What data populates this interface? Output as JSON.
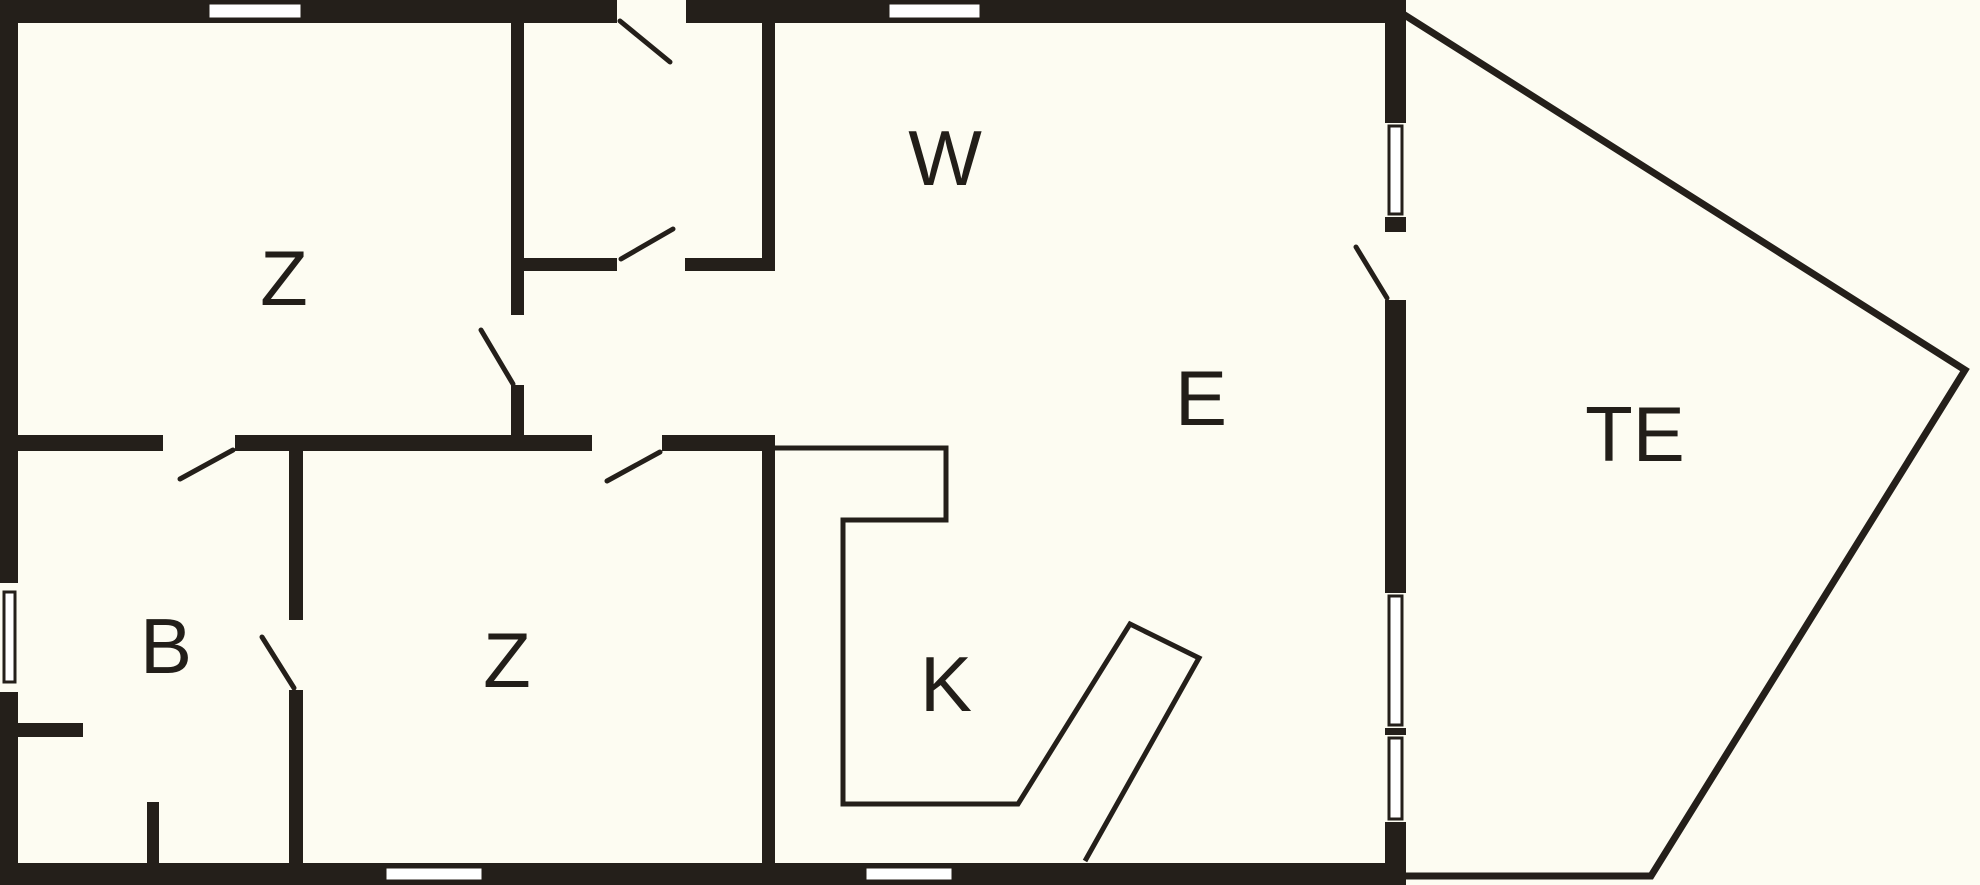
{
  "meta": {
    "title": "floor-plan",
    "canvas": {
      "w": 1980,
      "h": 885
    }
  },
  "colors": {
    "background": "#fdfcf2",
    "wall": "#241f1a",
    "line": "#241f1a",
    "window_fill": "#ffffff",
    "label": "#221e19"
  },
  "plan": {
    "font_size": 78,
    "stroke_widths": {
      "window": 3,
      "swing": 5,
      "counter": 5,
      "terrace": 7
    },
    "labels": [
      {
        "id": "room-label-z-top",
        "text": "Z",
        "x": 284,
        "y": 278
      },
      {
        "id": "room-label-w",
        "text": "W",
        "x": 945,
        "y": 158
      },
      {
        "id": "room-label-e",
        "text": "E",
        "x": 1201,
        "y": 398
      },
      {
        "id": "room-label-te",
        "text": "TE",
        "x": 1635,
        "y": 434
      },
      {
        "id": "room-label-b",
        "text": "B",
        "x": 166,
        "y": 646
      },
      {
        "id": "room-label-z-bottom",
        "text": "Z",
        "x": 507,
        "y": 660
      },
      {
        "id": "room-label-k",
        "text": "K",
        "x": 946,
        "y": 684
      }
    ],
    "walls": [
      {
        "id": "wall-top",
        "x": 0,
        "y": 0,
        "w": 1405,
        "h": 23
      },
      {
        "id": "wall-left",
        "x": 0,
        "y": 0,
        "w": 18,
        "h": 885
      },
      {
        "id": "wall-bottom",
        "x": 0,
        "y": 863,
        "w": 1405,
        "h": 22
      },
      {
        "id": "wall-right",
        "x": 1385,
        "y": 0,
        "w": 21,
        "h": 885
      },
      {
        "id": "wall-z1-east",
        "x": 511,
        "y": 23,
        "w": 13,
        "h": 412
      },
      {
        "id": "wall-hall-south",
        "x": 523,
        "y": 258,
        "w": 252,
        "h": 13
      },
      {
        "id": "wall-hall-east",
        "x": 762,
        "y": 23,
        "w": 13,
        "h": 248
      },
      {
        "id": "wall-mid-divider",
        "x": 18,
        "y": 435,
        "w": 757,
        "h": 16
      },
      {
        "id": "wall-b-east",
        "x": 289,
        "y": 451,
        "w": 14,
        "h": 412
      },
      {
        "id": "wall-k-west",
        "x": 762,
        "y": 435,
        "w": 13,
        "h": 428
      },
      {
        "id": "wall-b-stub-h",
        "x": 18,
        "y": 723,
        "w": 65,
        "h": 14
      },
      {
        "id": "wall-b-stub-v",
        "x": 147,
        "y": 802,
        "w": 12,
        "h": 61
      }
    ],
    "openings": [
      {
        "id": "opening-entry-door",
        "x": 617,
        "y": 0,
        "w": 69,
        "h": 23
      },
      {
        "id": "opening-hall-south-door",
        "x": 617,
        "y": 258,
        "w": 68,
        "h": 13
      },
      {
        "id": "opening-z1-door",
        "x": 511,
        "y": 315,
        "w": 13,
        "h": 70
      },
      {
        "id": "opening-divider-b-door",
        "x": 163,
        "y": 435,
        "w": 72,
        "h": 16
      },
      {
        "id": "opening-divider-z-door",
        "x": 592,
        "y": 435,
        "w": 70,
        "h": 16
      },
      {
        "id": "opening-b-east-door",
        "x": 289,
        "y": 620,
        "w": 14,
        "h": 70
      },
      {
        "id": "opening-right-door",
        "x": 1385,
        "y": 232,
        "w": 21,
        "h": 68
      },
      {
        "id": "opening-left-window",
        "x": 0,
        "y": 583,
        "w": 18,
        "h": 109
      },
      {
        "id": "opening-right-window-1",
        "x": 1385,
        "y": 123,
        "w": 21,
        "h": 94
      },
      {
        "id": "opening-right-window-2",
        "x": 1385,
        "y": 593,
        "w": 21,
        "h": 135
      },
      {
        "id": "opening-right-window-3",
        "x": 1385,
        "y": 735,
        "w": 21,
        "h": 87
      }
    ],
    "windows": [
      {
        "id": "window-top-1",
        "x": 208,
        "y": 3,
        "w": 94,
        "h": 16
      },
      {
        "id": "window-top-2",
        "x": 888,
        "y": 3,
        "w": 93,
        "h": 16
      },
      {
        "id": "window-left",
        "x": 4,
        "y": 592,
        "w": 11,
        "h": 90
      },
      {
        "id": "window-right-1",
        "x": 1389,
        "y": 126,
        "w": 13,
        "h": 88
      },
      {
        "id": "window-right-2",
        "x": 1389,
        "y": 596,
        "w": 13,
        "h": 129
      },
      {
        "id": "window-right-3",
        "x": 1389,
        "y": 738,
        "w": 13,
        "h": 81
      },
      {
        "id": "window-bottom-1",
        "x": 385,
        "y": 867,
        "w": 98,
        "h": 14
      },
      {
        "id": "window-bottom-2",
        "x": 865,
        "y": 867,
        "w": 88,
        "h": 14
      }
    ],
    "door_swings": [
      {
        "id": "swing-entry-door",
        "x1": 620,
        "y1": 21,
        "x2": 670,
        "y2": 62
      },
      {
        "id": "swing-hall-south-door",
        "x1": 621,
        "y1": 259,
        "x2": 673,
        "y2": 229
      },
      {
        "id": "swing-z1-door",
        "x1": 513,
        "y1": 384,
        "x2": 481,
        "y2": 330
      },
      {
        "id": "swing-divider-b-door",
        "x1": 233,
        "y1": 450,
        "x2": 180,
        "y2": 479
      },
      {
        "id": "swing-divider-z-door",
        "x1": 660,
        "y1": 452,
        "x2": 607,
        "y2": 481
      },
      {
        "id": "swing-b-east-door",
        "x1": 294,
        "y1": 688,
        "x2": 262,
        "y2": 637
      },
      {
        "id": "swing-right-door",
        "x1": 1387,
        "y1": 298,
        "x2": 1356,
        "y2": 247
      }
    ],
    "outlines": [
      {
        "id": "kitchen-counter-outline",
        "points": "775,448 946,448 946,520 843,520 843,804 1018,804 1130,624 1199,658 1085,861",
        "stroke_key": "counter"
      },
      {
        "id": "terrace-outline",
        "points": "1403,14 1965,370 1651,876 1403,876",
        "stroke_key": "terrace"
      }
    ]
  }
}
